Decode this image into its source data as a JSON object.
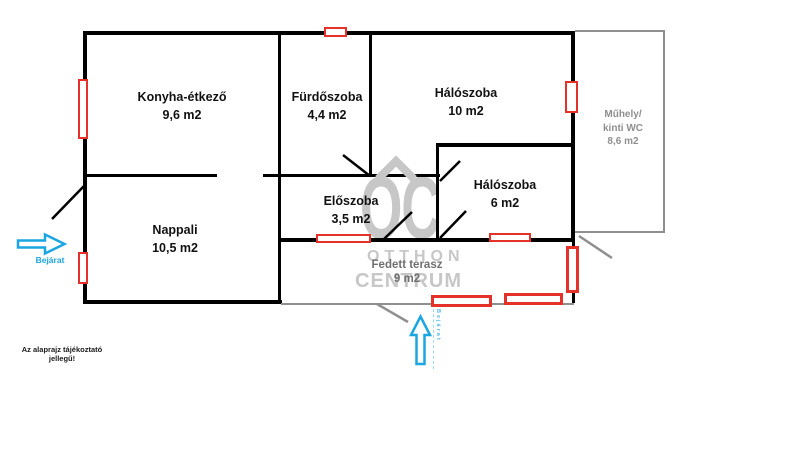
{
  "rooms": [
    {
      "id": "konyha",
      "name": "Konyha-étkező",
      "area": "9,6 m2"
    },
    {
      "id": "furdoszoba",
      "name": "Fürdőszoba",
      "area": "4,4 m2"
    },
    {
      "id": "haloszoba-nagy",
      "name": "Hálószoba",
      "area": "10 m2"
    },
    {
      "id": "haloszoba-kis",
      "name": "Hálószoba",
      "area": "6 m2"
    },
    {
      "id": "eloszoba",
      "name": "Előszoba",
      "area": "3,5 m2"
    },
    {
      "id": "nappali",
      "name": "Nappali",
      "area": "10,5 m2"
    },
    {
      "id": "muhely",
      "line1": "Műhely/",
      "line2": "kinti WC",
      "area": "8,6 m2"
    },
    {
      "id": "terasz",
      "name": "Fedett terasz",
      "area": "9 m2"
    }
  ],
  "annotations": {
    "entrance_side_label": "Bejárat",
    "entrance_bottom_label": "Bejárat",
    "disclaimer_line1": "Az alaprajz tájékoztató",
    "disclaimer_line2": "jellegű!"
  },
  "watermark": {
    "logo": "OC",
    "line1": "OTTHON",
    "line2": "CENTRUM"
  },
  "colors": {
    "wall": "#000000",
    "window": "#e4322b",
    "outbuilding_outline": "#8f8f8f",
    "entrance_arrow": "#1ca6e1",
    "watermark": "#c7c7c7"
  }
}
